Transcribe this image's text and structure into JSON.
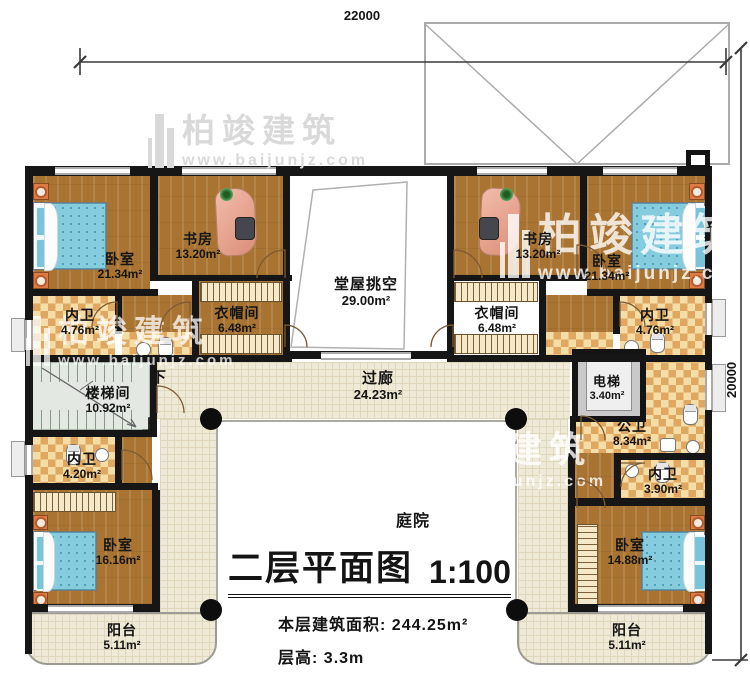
{
  "dimensions": {
    "top": "22000",
    "right": "20000"
  },
  "watermark": {
    "brand": "柏竣建筑",
    "url": "www.baijunjz.com"
  },
  "stairs": {
    "down": "下",
    "up": "上"
  },
  "rooms": {
    "bedroom_tl": {
      "name": "卧室",
      "area": "21.34m²"
    },
    "study_l": {
      "name": "书房",
      "area": "13.20m²"
    },
    "hall_void": {
      "name": "堂屋挑空",
      "area": "29.00m²"
    },
    "cloak_l": {
      "name": "衣帽间",
      "area": "6.48m²"
    },
    "bath_tl": {
      "name": "内卫",
      "area": "4.76m²"
    },
    "study_r": {
      "name": "书房",
      "area": "13.20m²"
    },
    "bedroom_tr": {
      "name": "卧室",
      "area": "21.34m²"
    },
    "cloak_r": {
      "name": "衣帽间",
      "area": "6.48m²"
    },
    "bath_tr": {
      "name": "内卫",
      "area": "4.76m²"
    },
    "stairwell": {
      "name": "楼梯间",
      "area": "10.92m²"
    },
    "corridor": {
      "name": "过廊",
      "area": "24.23m²"
    },
    "elevator": {
      "name": "电梯",
      "area": "3.40m²"
    },
    "public_bath": {
      "name": "公卫",
      "area": "8.34m²"
    },
    "bath_bl": {
      "name": "内卫",
      "area": "4.20m²"
    },
    "bath_br": {
      "name": "内卫",
      "area": "3.90m²"
    },
    "bedroom_bl": {
      "name": "卧室",
      "area": "16.16m²"
    },
    "bedroom_br": {
      "name": "卧室",
      "area": "14.88m²"
    },
    "balcony_l": {
      "name": "阳台",
      "area": "5.11m²"
    },
    "balcony_r": {
      "name": "阳台",
      "area": "5.11m²"
    },
    "courtyard": {
      "name": "庭院"
    }
  },
  "title": {
    "main": "二层平面图",
    "scale": "1:100",
    "area_label": "本层建筑面积:",
    "area_value": "244.25m²",
    "floor_height_label": "层高:",
    "floor_height_value": "3.3m"
  },
  "colors": {
    "wall": "#161616",
    "wood_floor": "#a97431",
    "bath_tile": "#dfa75f",
    "corridor_tile": "#efead8",
    "bed": "#85ccdf",
    "desk": "#db8e77",
    "nightstand": "#de7a43"
  }
}
